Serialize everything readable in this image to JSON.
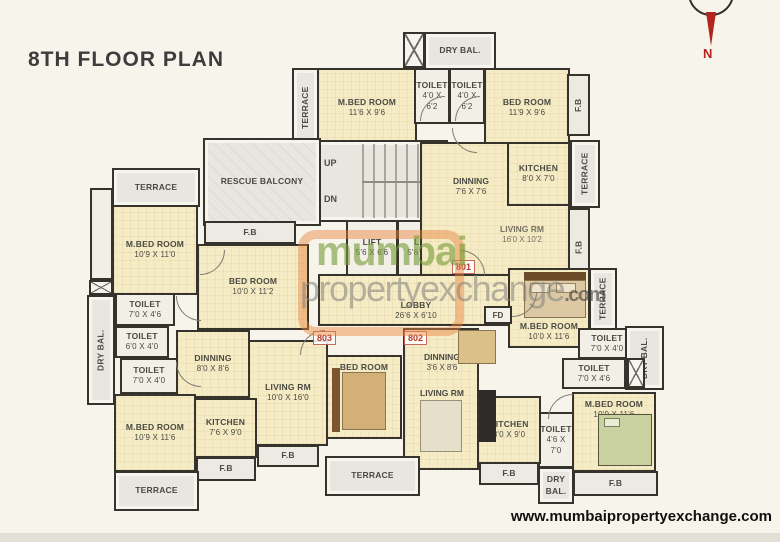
{
  "page": {
    "title": "8TH FLOOR PLAN",
    "footer_url": "www.mumbaipropertyexchange.com",
    "compass_label": "N"
  },
  "watermark": {
    "word1": "mumbai",
    "word2": "propertyexchange",
    "word3": ".com"
  },
  "unit_badges": {
    "u801": "801",
    "u802": "802",
    "u803": "803"
  },
  "misc": {
    "up": "UP",
    "dn": "DN",
    "fd": "FD"
  },
  "colors": {
    "wall": "#35332c",
    "room_fill": "#f5ecc6",
    "terrace_fill": "#e8e6df",
    "unit_number_red": "#b5372b",
    "compass_red": "#b3251f",
    "watermark_orange": "#e8833a",
    "watermark_green": "#789c3a"
  },
  "rooms": {
    "terrace_tl": {
      "name": "TERRACE",
      "dims": ""
    },
    "mbed_tl": {
      "name": "M.BED ROOM",
      "dims": "10'9 X 11'0"
    },
    "fb_tl": {
      "name": "F.B",
      "dims": ""
    },
    "bed_l": {
      "name": "BED ROOM",
      "dims": "10'0 X 11'2"
    },
    "toilet_l1": {
      "name": "TOILET",
      "dims": "7'0 X 4'6"
    },
    "toilet_l2": {
      "name": "TOILET",
      "dims": "6'0 X 4'0"
    },
    "toilet_l3": {
      "name": "TOILET",
      "dims": "7'0 X 4'0"
    },
    "drybal_l": {
      "name": "DRY BAL.",
      "dims": ""
    },
    "dinning_804": {
      "name": "DINNING",
      "dims": "8'0 X 8'6"
    },
    "mbed_bl": {
      "name": "M.BED ROOM",
      "dims": "10'9 X 11'6"
    },
    "kitchen_804": {
      "name": "KITCHEN",
      "dims": "7'6 X 9'0"
    },
    "fb_bl": {
      "name": "F.B",
      "dims": ""
    },
    "terrace_bl": {
      "name": "TERRACE",
      "dims": ""
    },
    "living_803": {
      "name": "LIVING RM",
      "dims": "10'0 X 16'0"
    },
    "fb_803": {
      "name": "F.B",
      "dims": ""
    },
    "bed_803": {
      "name": "BED ROOM",
      "dims": "10'0 X 10'6"
    },
    "terrace_bc": {
      "name": "TERRACE",
      "dims": ""
    },
    "dinning_802": {
      "name": "DINNING",
      "dims": "3'6 X 8'6"
    },
    "living_802": {
      "name": "LIVING RM",
      "dims": "10'0 X 16'0"
    },
    "kitchen_802": {
      "name": "KITCHEN",
      "dims": "8'0 X 9'0"
    },
    "fb_802k": {
      "name": "F.B",
      "dims": ""
    },
    "toilet_802": {
      "name": "TOILET",
      "dims": "4'6 X 7'0"
    },
    "drybal_802": {
      "name": "DRY BAL.",
      "dims": ""
    },
    "mbed_802": {
      "name": "M.BED ROOM",
      "dims": "10'0 X 11'6"
    },
    "fb_802": {
      "name": "F.B",
      "dims": ""
    },
    "rescue": {
      "name": "RESCUE BALCONY",
      "dims": ""
    },
    "terrace_tc": {
      "name": "TERRACE",
      "dims": ""
    },
    "mbed_tc": {
      "name": "M.BED ROOM",
      "dims": "11'6 X 9'6"
    },
    "drybal_t": {
      "name": "DRY BAL.",
      "dims": ""
    },
    "toilet_t1": {
      "name": "TOILET",
      "dims": "4'0 X 6'2"
    },
    "toilet_t2": {
      "name": "TOILET",
      "dims": "4'0 X 6'2"
    },
    "bed_tr": {
      "name": "BED ROOM",
      "dims": "11'9 X 9'6"
    },
    "fb_tr": {
      "name": "F.B",
      "dims": ""
    },
    "kitchen_801": {
      "name": "KITCHEN",
      "dims": "8'0 X 7'0"
    },
    "terrace_tr": {
      "name": "TERRACE",
      "dims": ""
    },
    "dinning_801": {
      "name": "DINNING",
      "dims": "7'6 X 7'6"
    },
    "living_801": {
      "name": "LIVING RM",
      "dims": "16'0 X 10'2"
    },
    "fb_801": {
      "name": "F.B",
      "dims": ""
    },
    "mbed_801": {
      "name": "M.BED ROOM",
      "dims": "10'0 X 11'6"
    },
    "terrace_801": {
      "name": "TERRACE",
      "dims": ""
    },
    "toilet_801a": {
      "name": "TOILET",
      "dims": "7'0 X 4'0"
    },
    "toilet_801b": {
      "name": "TOILET",
      "dims": "7'0 X 4'6"
    },
    "drybal_r": {
      "name": "DRY BAL.",
      "dims": ""
    },
    "lift1": {
      "name": "LIFT",
      "dims": "5'6 X 6'6"
    },
    "lift2": {
      "name": "LIFT",
      "dims": "5'6 X 6'6"
    },
    "lobby": {
      "name": "LOBBY",
      "dims": "26'6 X 6'10"
    }
  }
}
